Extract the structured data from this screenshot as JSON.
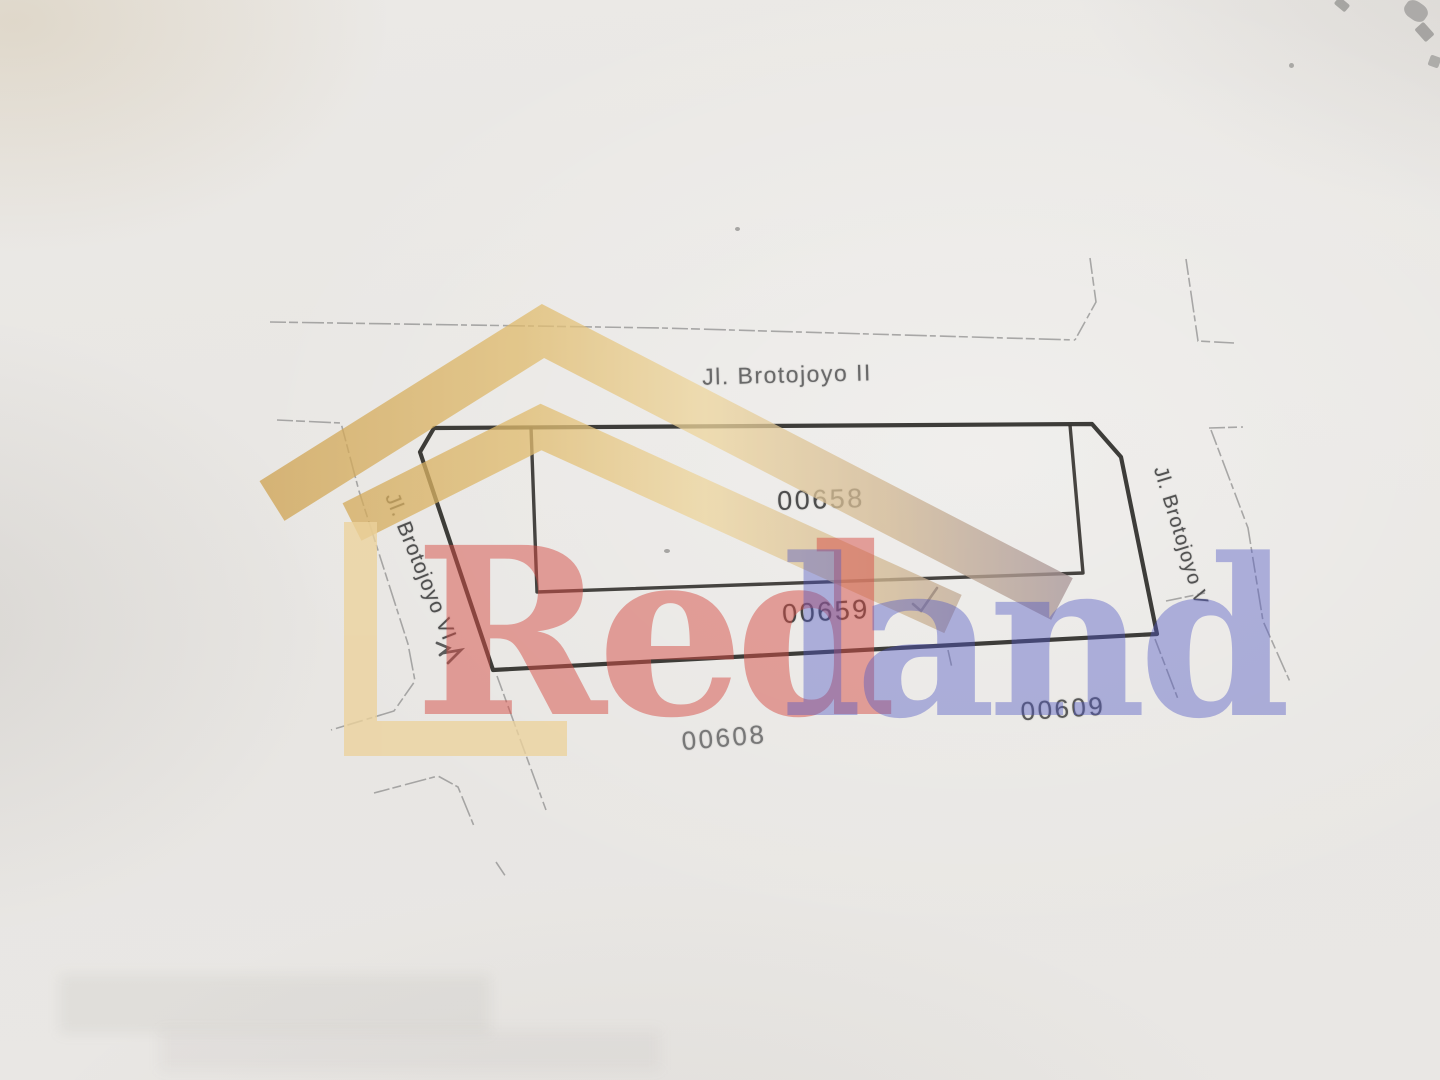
{
  "map": {
    "streets": [
      {
        "label": "Jl. Brotojoyo II",
        "side": "top"
      },
      {
        "label": "Jl. Brotojoyo V",
        "side": "right"
      },
      {
        "label": "Jl. Brotojoyo VI",
        "side": "left"
      }
    ],
    "parcels": [
      {
        "id": "00658",
        "position": "inside-plot-upper"
      },
      {
        "id": "00659",
        "position": "inside-plot-lower-strip"
      },
      {
        "id": "00608",
        "position": "south-west-of-plot"
      },
      {
        "id": "00609",
        "position": "south-east-of-plot"
      }
    ],
    "annotations": [
      {
        "icon": "checkmark",
        "near_parcel": "00659"
      }
    ]
  },
  "watermark": {
    "word_red": "Red",
    "word_land": "land",
    "icons": [
      "roof-chevron",
      "corner-bracket"
    ],
    "colors": {
      "gold": "#d9b269",
      "red": "#d64d46",
      "periwinkle": "#5258c4"
    }
  },
  "palette": {
    "paper": "#e9e7e4",
    "line_dark": "#2e2c29",
    "line_faint": "#7d7d7d"
  }
}
